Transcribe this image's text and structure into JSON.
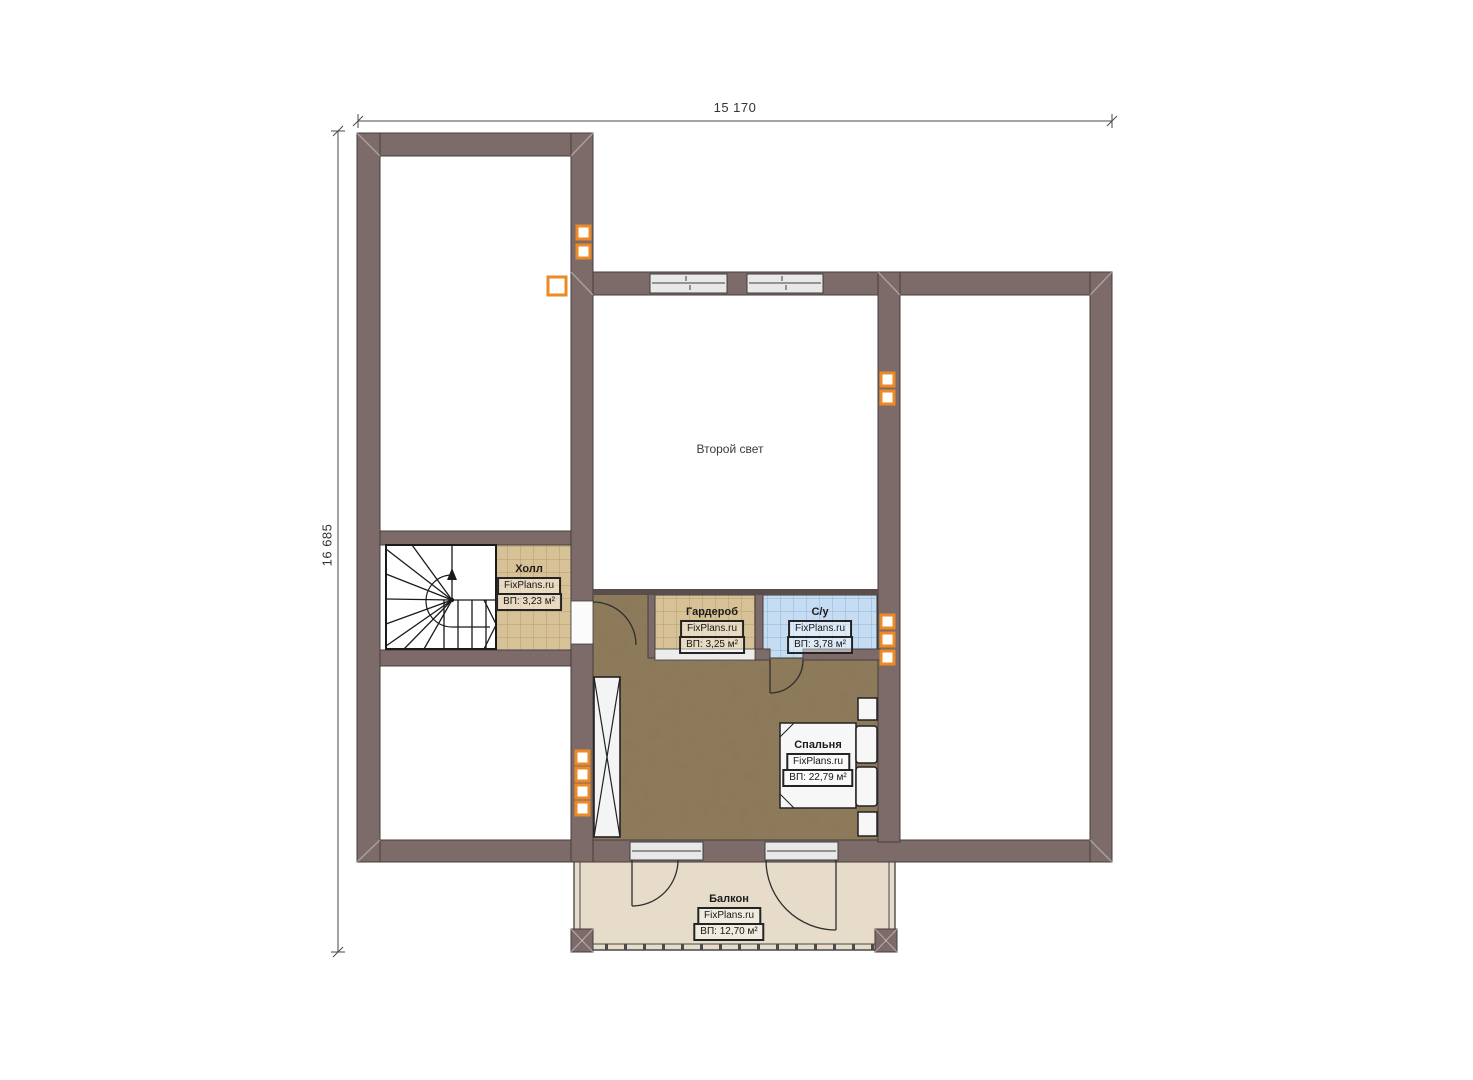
{
  "plan": {
    "dimensions": {
      "width_label": "15 170",
      "height_label": "16 685"
    },
    "rooms": {
      "second_light": {
        "name": "Второй свет"
      },
      "hall": {
        "name": "Холл",
        "brand": "FixPlans.ru",
        "area": "ВП: 3,23 м²"
      },
      "wardrobe": {
        "name": "Гардероб",
        "brand": "FixPlans.ru",
        "area": "ВП: 3,25 м²"
      },
      "bathroom": {
        "name": "С/у",
        "brand": "FixPlans.ru",
        "area": "ВП: 3,78 м²"
      },
      "bedroom": {
        "name": "Спальня",
        "brand": "FixPlans.ru",
        "area": "ВП: 22,79 м²"
      },
      "balcony": {
        "name": "Балкон",
        "brand": "FixPlans.ru",
        "area": "ВП: 12,70 м²"
      }
    },
    "colors": {
      "wall": "#7d6b6a",
      "marker_accent": "#ec8a25",
      "tile_tan": "#d7c297",
      "tile_blue": "#c5dcf3",
      "bedroom_floor": "#8b7859",
      "balcony_floor": "#e6dcc9"
    }
  }
}
